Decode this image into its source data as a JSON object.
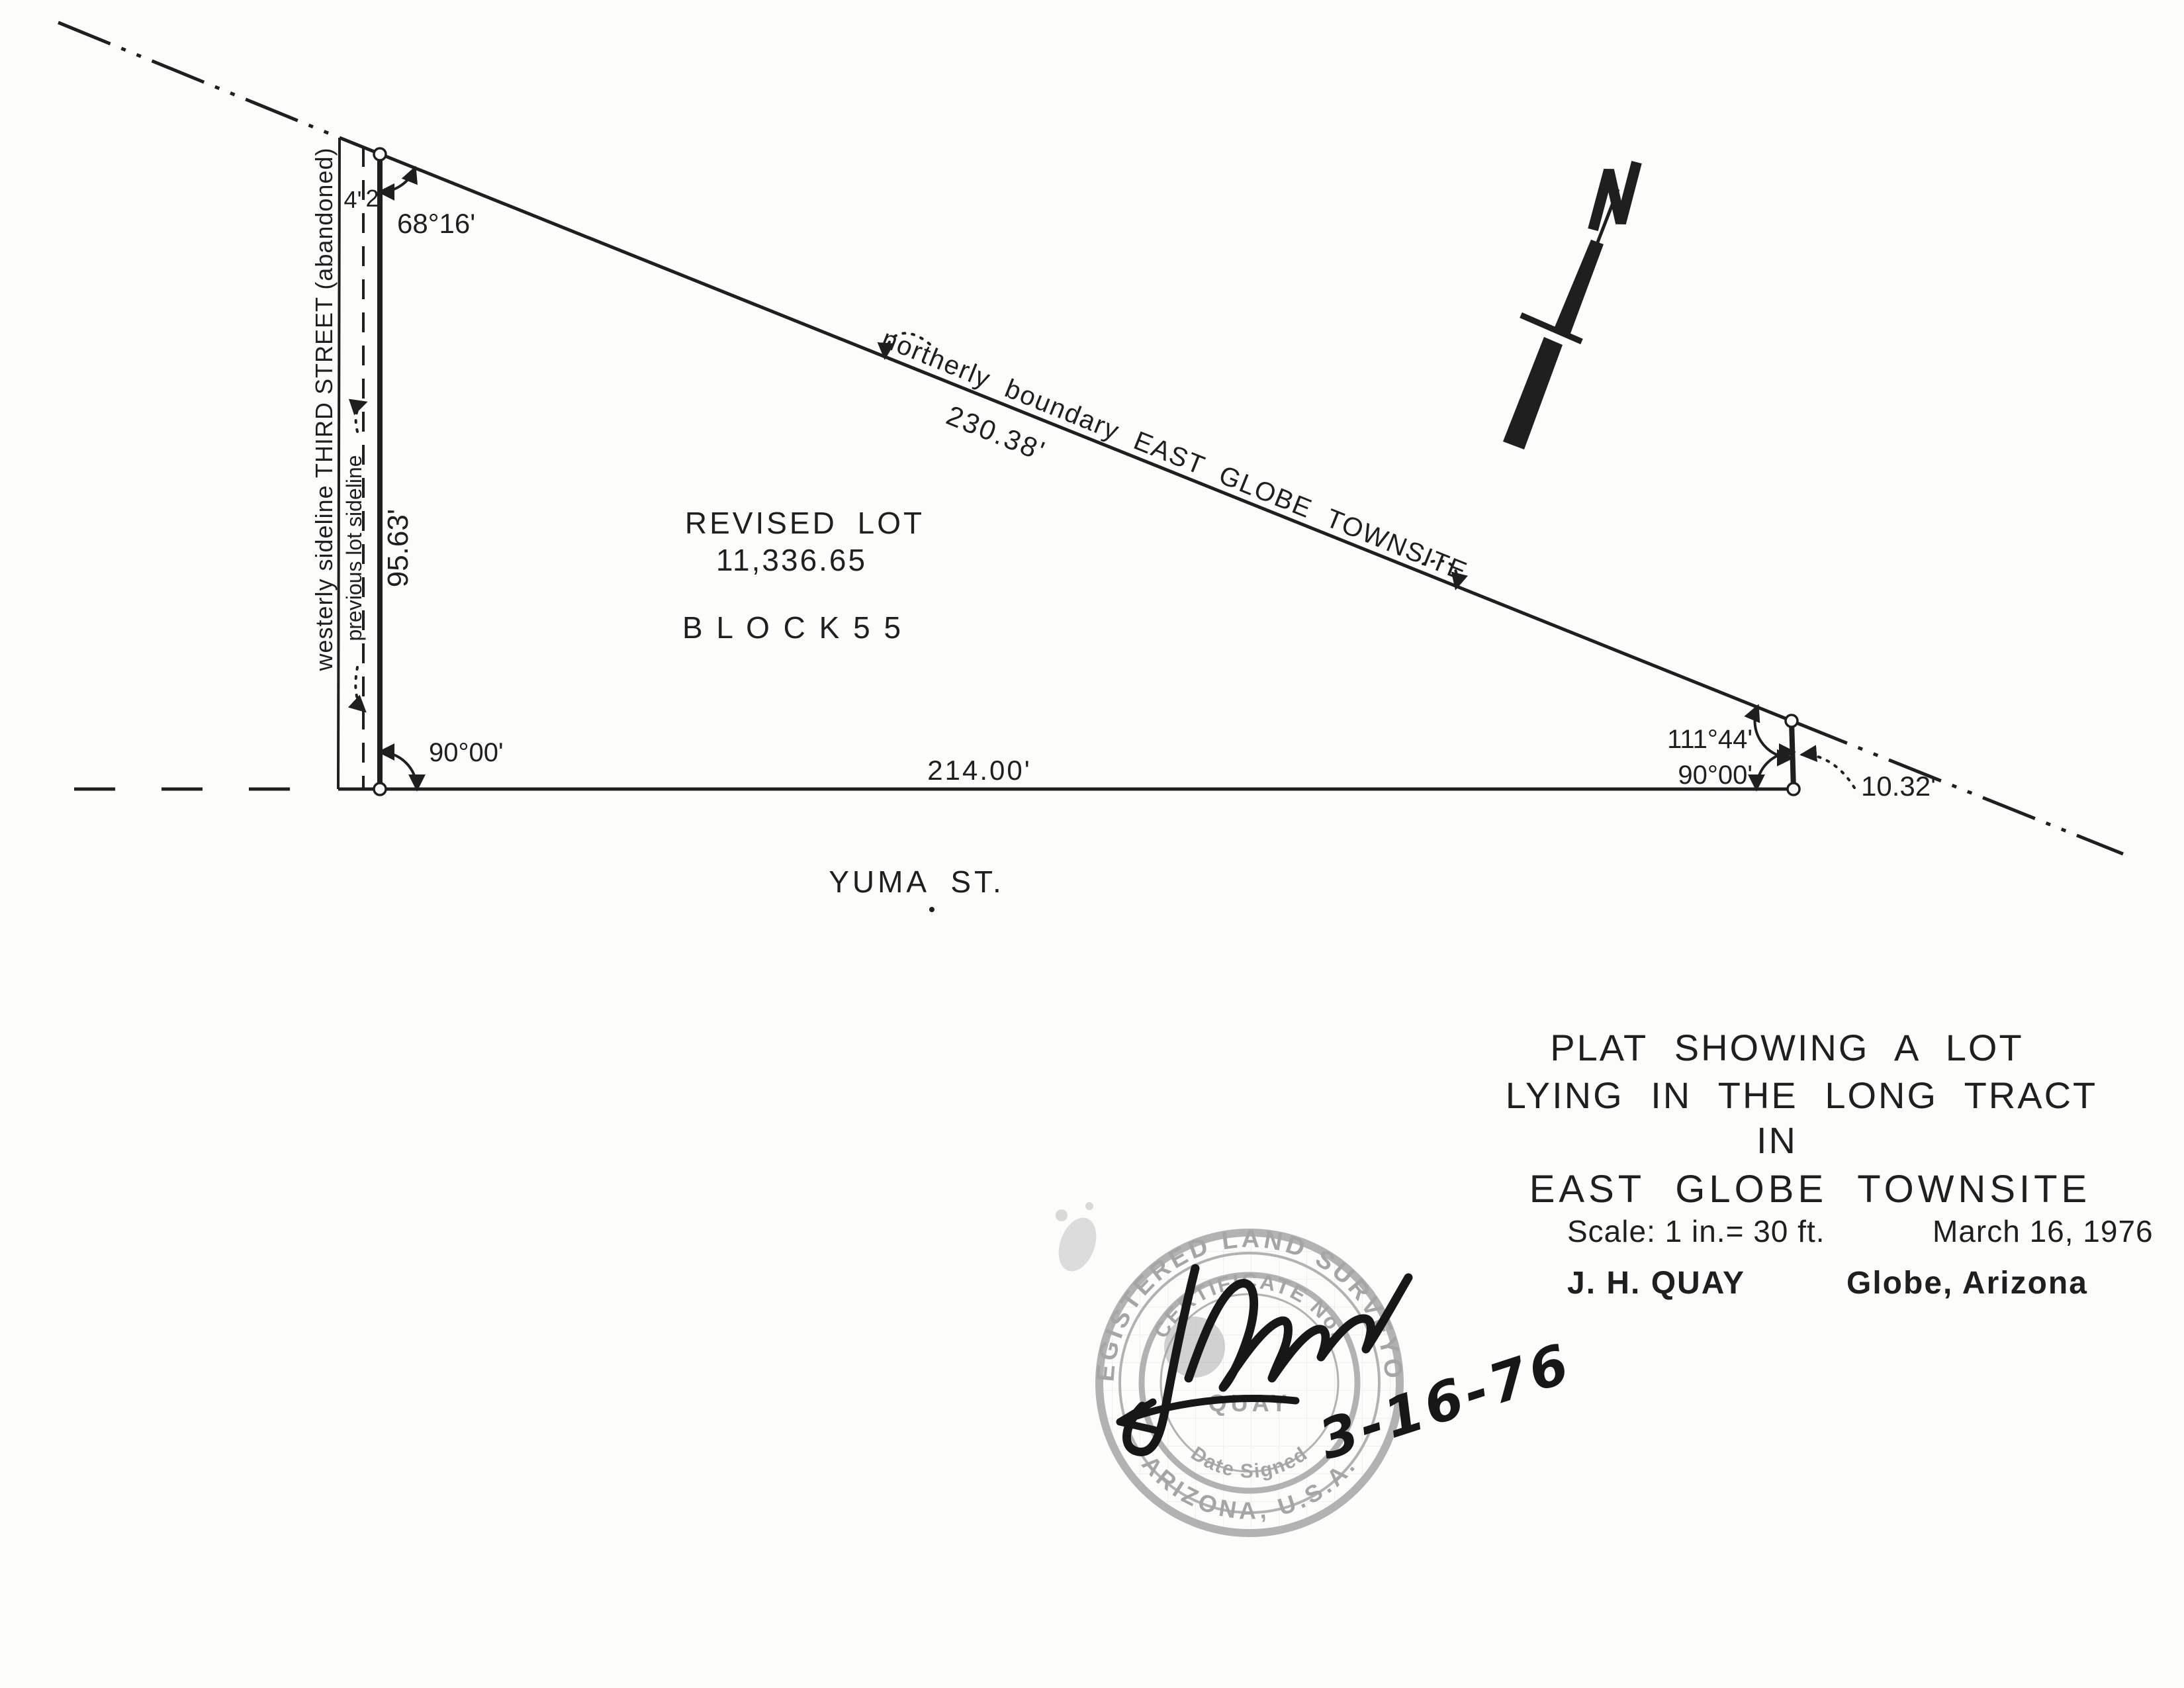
{
  "colors": {
    "ink": "#1f1f1f",
    "stamp": "#a5a5a5",
    "paper": "#fcfcfb",
    "signature": "#171717"
  },
  "drawing": {
    "west_strip": {
      "street_label": "westerly sideline THIRD STREET (abandoned)",
      "previous_sideline_label": "previous lot sideline",
      "offset_left": "4'",
      "offset_right": "2'",
      "west_length": "95.63'"
    },
    "angles": {
      "northwest": "68°16'",
      "southwest": "90°00'",
      "northeast": "111°44'",
      "southeast": "90°00'"
    },
    "boundaries": {
      "north_label": "northerly boundary EAST GLOBE TOWNSITE",
      "north_length": "230.38'",
      "south_length": "214.00'",
      "east_length": "10.32'"
    },
    "lot": {
      "name": "REVISED  LOT",
      "area": "11,336.65",
      "block": "B L O C K      5 5"
    },
    "street": "YUMA  ST."
  },
  "title_block": {
    "line1": "PLAT SHOWING A LOT",
    "line2": "LYING IN THE LONG TRACT",
    "line3": "IN",
    "line4": "EAST GLOBE TOWNSITE",
    "scale": "Scale: 1 in.= 30 ft.",
    "date": "March 16, 1976",
    "surveyor": "J. H. QUAY",
    "location": "Globe, Arizona"
  },
  "stamp": {
    "outer_top": "REGISTERED LAND SURVEYOR",
    "outer_bottom": "ARIZONA, U.S.A.",
    "inner_top": "CERTIFICATE No.",
    "name": "QUAY",
    "inner_bottom": "Date Signed",
    "handwritten_date": "3-16-76"
  }
}
